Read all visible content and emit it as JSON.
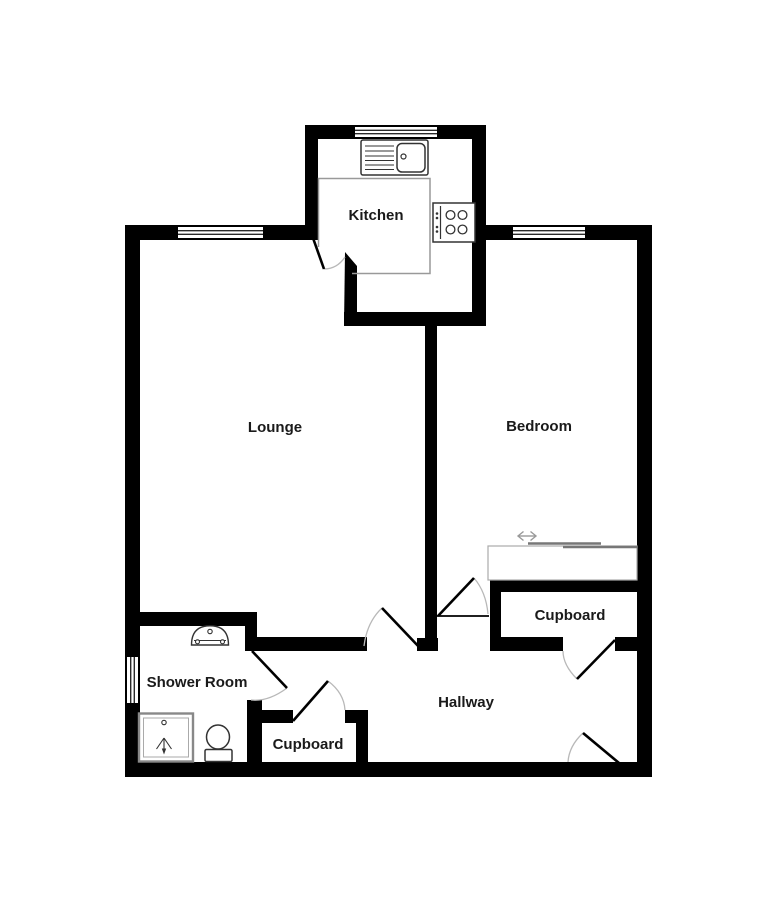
{
  "plan": {
    "type": "floorplan",
    "rooms": {
      "kitchen": {
        "label": "Kitchen"
      },
      "lounge": {
        "label": "Lounge"
      },
      "bedroom": {
        "label": "Bedroom"
      },
      "shower_room": {
        "label": "Shower Room"
      },
      "hallway": {
        "label": "Hallway"
      },
      "cupboard_bedroom": {
        "label": "Cupboard"
      },
      "cupboard_hall": {
        "label": "Cupboard"
      }
    },
    "fixtures": [
      "kitchen-sink",
      "kitchen-hob",
      "kitchen-counter",
      "wash-basin",
      "toilet",
      "shower-tray",
      "sliding-wardrobe"
    ],
    "colors": {
      "wall": "#000000",
      "background": "#ffffff",
      "door_leaf": "#000000",
      "door_arc": "#b8b8b8",
      "fixture_outline": "#333333",
      "counter_outline": "#999999",
      "wardrobe_line": "#777777",
      "window_line": "#2a2a2a",
      "label_text": "#1a1a1a"
    }
  }
}
